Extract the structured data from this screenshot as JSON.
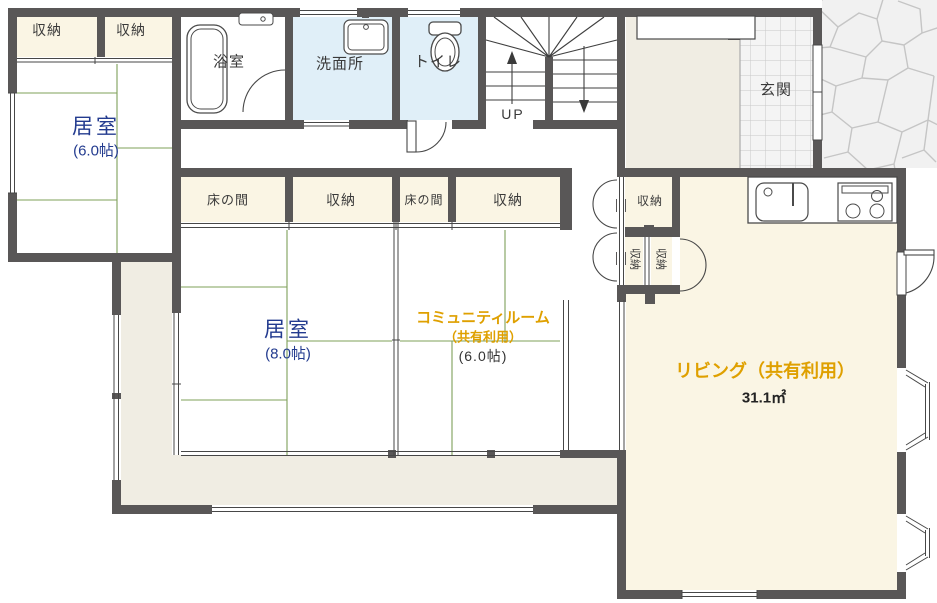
{
  "plan": {
    "rooms": {
      "storage_a": "収納",
      "storage_b": "収納",
      "room6_name": "居室",
      "room6_size": "(6.0帖)",
      "bathroom": "浴室",
      "washroom": "洗面所",
      "toilet": "トイレ",
      "stairs_up": "UP",
      "genkan": "玄関",
      "tokonoma_a": "床の間",
      "storage_c": "収納",
      "tokonoma_b": "床の間",
      "storage_d": "収納",
      "storage_e": "収納",
      "storage_f": "収納",
      "storage_g": "収納",
      "room8_name": "居室",
      "room8_size": "(8.0帖)",
      "community_name": "コミュニティルーム",
      "community_shared": "（共有利用）",
      "community_size": "(6.0帖)",
      "living_name": "リビング（共有利用）",
      "living_area": "31.1㎡"
    },
    "colors": {
      "wall": "#595757",
      "tatami_line": "#7FA05A",
      "cream_room": "#FAF5E4",
      "water_room_blue": "#E0EFF8",
      "veranda": "#F0EDE3",
      "genkan_tile": "#F4F4F4",
      "label_navy": "#233B8F",
      "label_orange": "#DFA000"
    }
  }
}
